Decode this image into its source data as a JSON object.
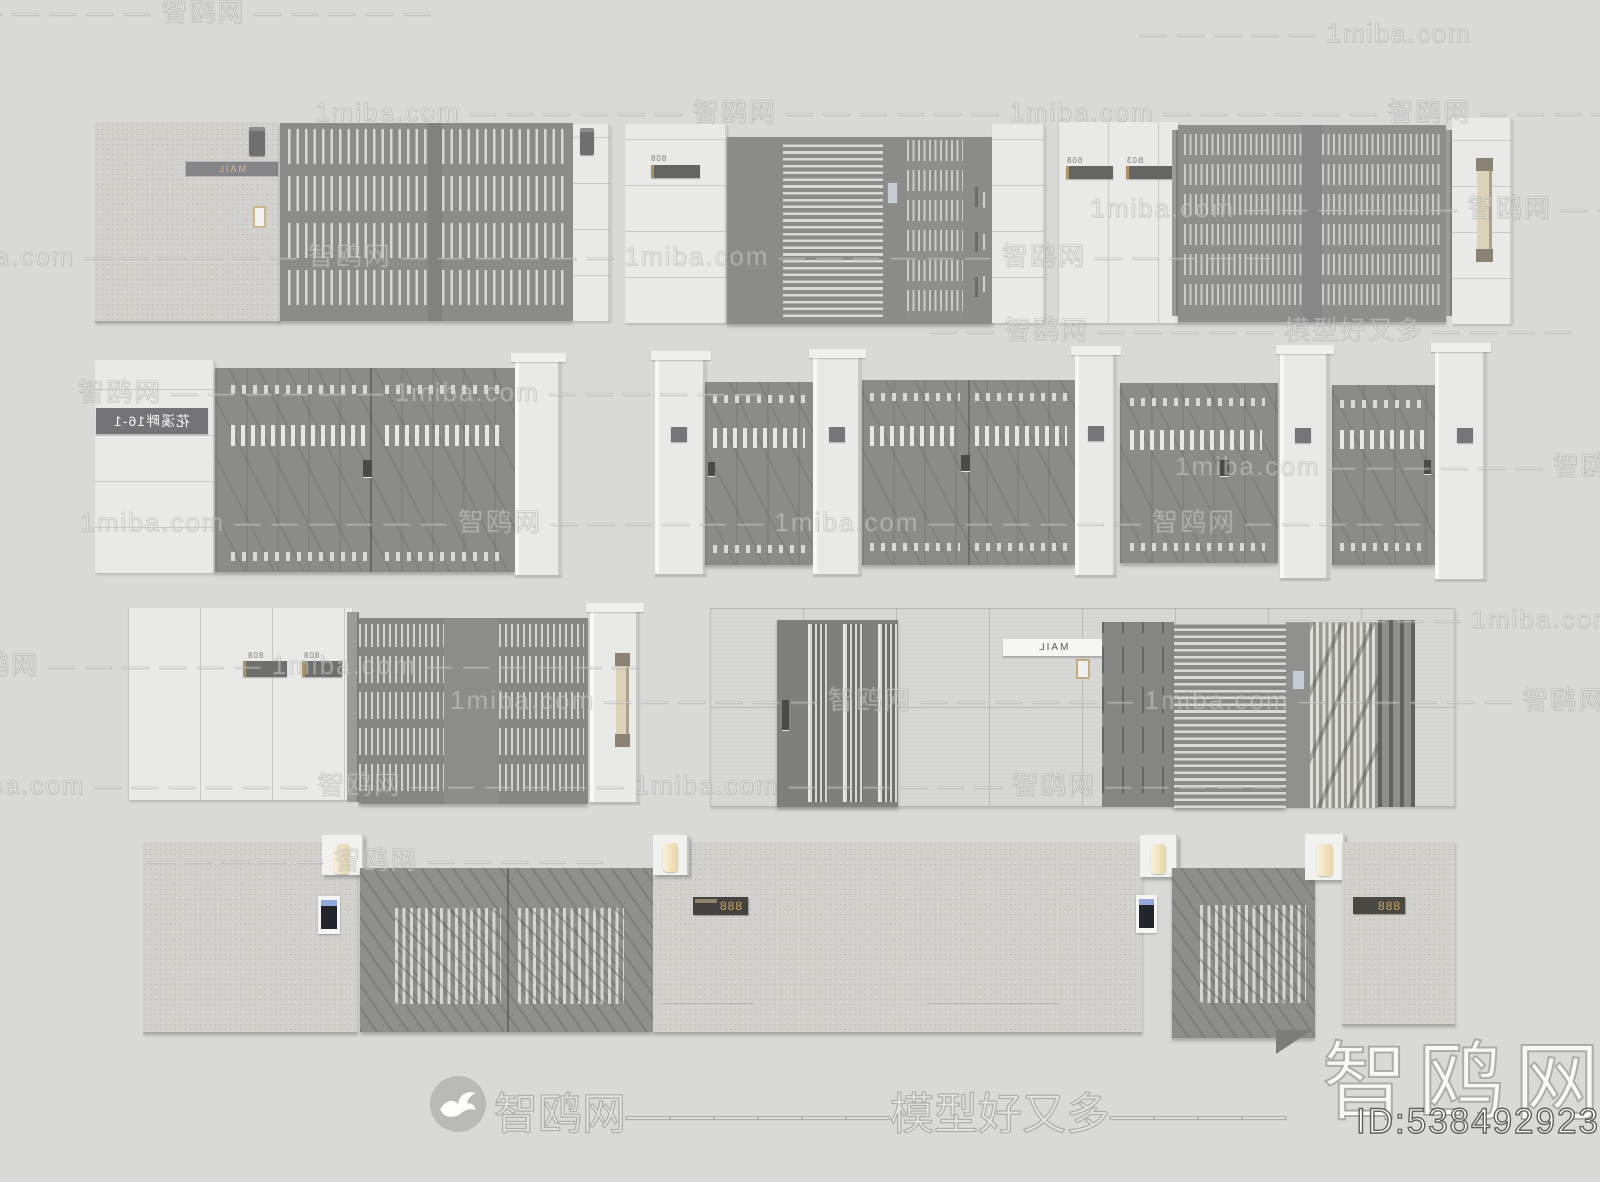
{
  "watermark": {
    "brand": "智鸥网",
    "site": "1miba.com",
    "tagline": "模型好又多",
    "rows": {
      "long": "1miba.com — — — — — — 智鸥网 — — — — — — 1miba.com — — — — — — 智鸥网 — — — — —",
      "dash_site": "— — — — — 1miba.com",
      "dash_brand": "— — — — — 智鸥网 — — — — —",
      "brand_first": "智鸥网 — — — — — — 1miba.com — — — — — —",
      "brand_tagline": "— — 智鸥网 — — — — — 模型好又多 — — — —"
    },
    "footer_line": "智鸥网——————模型好又多————",
    "logo_text": "智鸥网",
    "model_id": "ID:538492923"
  },
  "signs": {
    "model1_plate": "MAIL",
    "model2_number": "808",
    "model3_number_a": "608",
    "model3_number_b": "B03",
    "model4_name": "花溪畔16-1",
    "model7_number_a": "808",
    "model7_number_b": "808",
    "model8_mail_plate": "MAIL",
    "model10_number": "888",
    "model11_number": "888"
  }
}
